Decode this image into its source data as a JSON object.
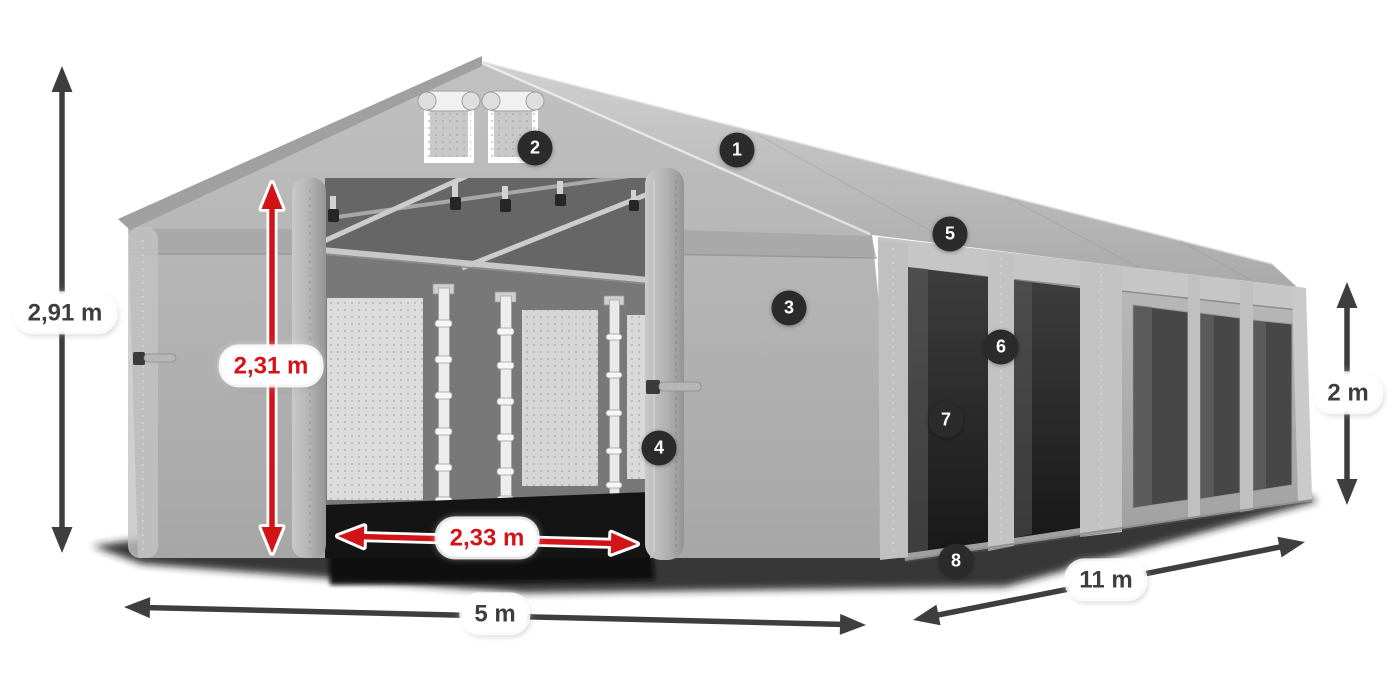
{
  "colors": {
    "dark": "#3e3e3e",
    "red": "#d21418",
    "badge_bg": "#2b2b2b",
    "badge_text": "#ffffff",
    "pill_bg": "#ffffff"
  },
  "dimensions": [
    {
      "id": "total-height",
      "label": "2,91 m",
      "color": "dark",
      "label_x": 65,
      "label_y": 313,
      "arrow": {
        "x1": 62,
        "y1": 66,
        "x2": 62,
        "y2": 553
      }
    },
    {
      "id": "entrance-height",
      "label": "2,31 m",
      "color": "red",
      "label_x": 271,
      "label_y": 366,
      "arrow": {
        "x1": 272,
        "y1": 183,
        "x2": 272,
        "y2": 553
      }
    },
    {
      "id": "entrance-width",
      "label": "2,33 m",
      "color": "red",
      "label_x": 487,
      "label_y": 538,
      "arrow": {
        "x1": 338,
        "y1": 536,
        "x2": 637,
        "y2": 544
      }
    },
    {
      "id": "width",
      "label": "5 m",
      "color": "dark",
      "label_x": 495,
      "label_y": 614,
      "arrow": {
        "x1": 124,
        "y1": 607,
        "x2": 866,
        "y2": 625
      }
    },
    {
      "id": "length",
      "label": "11 m",
      "color": "dark",
      "label_x": 1106,
      "label_y": 580,
      "arrow": {
        "x1": 913,
        "y1": 620,
        "x2": 1305,
        "y2": 542
      }
    },
    {
      "id": "side-height",
      "label": "2 m",
      "color": "dark",
      "label_x": 1348,
      "label_y": 393,
      "arrow": {
        "x1": 1347,
        "y1": 282,
        "x2": 1347,
        "y2": 505
      }
    }
  ],
  "callouts": [
    {
      "number": "1",
      "x": 737,
      "y": 150
    },
    {
      "number": "2",
      "x": 535,
      "y": 148
    },
    {
      "number": "3",
      "x": 789,
      "y": 308
    },
    {
      "number": "4",
      "x": 659,
      "y": 448
    },
    {
      "number": "5",
      "x": 950,
      "y": 234
    },
    {
      "number": "6",
      "x": 1001,
      "y": 347
    },
    {
      "number": "7",
      "x": 946,
      "y": 420
    },
    {
      "number": "8",
      "x": 956,
      "y": 561
    }
  ]
}
